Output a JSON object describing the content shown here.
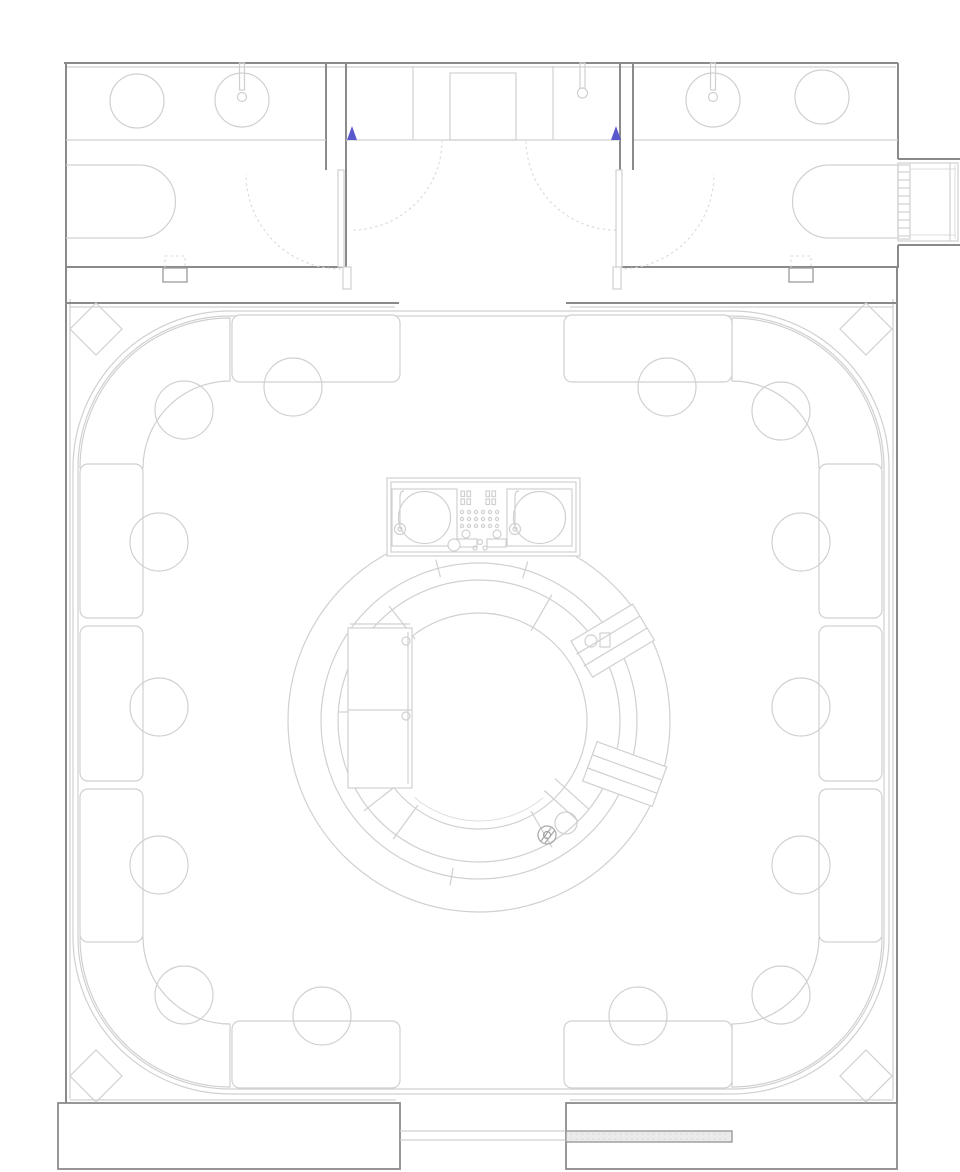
{
  "meta": {
    "kind": "architectural-floor-plan",
    "subject": "club-with-circular-bar-dj-booth-and-banquette-seating",
    "canvas": {
      "width": 960,
      "height": 1172
    }
  },
  "palette": {
    "bg": "#ffffff",
    "wall": "#8a8a8a",
    "wall-light": "#c6c6c6",
    "line": "#d0d0d0",
    "line-faint": "#dedede",
    "dash": "#d9d9d9",
    "blue": "#5b58cb",
    "slot-fill": "#ebebeb",
    "slot-edge": "#9a9a9a"
  },
  "furniture": {
    "table_radius": 29,
    "tables": [
      {
        "x": 184,
        "y": 410
      },
      {
        "x": 293,
        "y": 387
      },
      {
        "x": 667,
        "y": 387
      },
      {
        "x": 781,
        "y": 411
      },
      {
        "x": 159,
        "y": 542
      },
      {
        "x": 159,
        "y": 707
      },
      {
        "x": 159,
        "y": 865
      },
      {
        "x": 801,
        "y": 542
      },
      {
        "x": 801,
        "y": 707
      },
      {
        "x": 801,
        "y": 865
      },
      {
        "x": 184,
        "y": 995
      },
      {
        "x": 322,
        "y": 1016
      },
      {
        "x": 638,
        "y": 1016
      },
      {
        "x": 781,
        "y": 995
      }
    ],
    "column_half_diagonal": 26,
    "columns": [
      {
        "x": 96,
        "y": 329
      },
      {
        "x": 866,
        "y": 329
      },
      {
        "x": 96,
        "y": 1076
      },
      {
        "x": 866,
        "y": 1076
      }
    ],
    "bench_modules": [
      {
        "x": 232,
        "y": 315,
        "w": 168,
        "h": 67
      },
      {
        "x": 564,
        "y": 315,
        "w": 168,
        "h": 67
      },
      {
        "x": 80,
        "y": 464,
        "w": 63,
        "h": 154
      },
      {
        "x": 80,
        "y": 626,
        "w": 63,
        "h": 155
      },
      {
        "x": 80,
        "y": 789,
        "w": 63,
        "h": 153
      },
      {
        "x": 819,
        "y": 464,
        "w": 63,
        "h": 154
      },
      {
        "x": 819,
        "y": 626,
        "w": 63,
        "h": 155
      },
      {
        "x": 819,
        "y": 789,
        "w": 63,
        "h": 153
      },
      {
        "x": 232,
        "y": 1021,
        "w": 168,
        "h": 67
      },
      {
        "x": 564,
        "y": 1021,
        "w": 168,
        "h": 67
      }
    ],
    "corner_bench_r_inner": 87,
    "corner_bench_r_outer": 150,
    "corner_benches": [
      {
        "cx": 230,
        "cy": 468,
        "a0": 180,
        "a1": 270
      },
      {
        "cx": 732,
        "cy": 468,
        "a0": 270,
        "a1": 360
      },
      {
        "cx": 732,
        "cy": 937,
        "a0": 0,
        "a1": 90
      },
      {
        "cx": 230,
        "cy": 937,
        "a0": 90,
        "a1": 180
      }
    ]
  },
  "bar": {
    "cx": 479,
    "cy": 721,
    "radii": [
      191,
      158,
      141,
      108
    ],
    "tick_bands": [
      {
        "r1": 149,
        "r2": 167,
        "angles": [
          -105,
          -73,
          100
        ]
      },
      {
        "r1": 104,
        "r2": 146,
        "angles": [
          -128,
          -60,
          60,
          126,
          142
        ]
      }
    ]
  },
  "stair": {
    "rungs": {
      "x1": 898,
      "x2": 910,
      "y0": 172,
      "step": 8,
      "count": 9
    }
  },
  "dj_mixer": {
    "knob_rows": [
      512,
      519,
      526
    ],
    "knob_cols": [
      462,
      469,
      476,
      483,
      490,
      497
    ],
    "knob_r": 1.6,
    "switch_cols": [
      461,
      467,
      486,
      492
    ],
    "switch_rows": [
      491,
      499
    ],
    "switch_w": 3.5,
    "switch_h": 5.5
  }
}
